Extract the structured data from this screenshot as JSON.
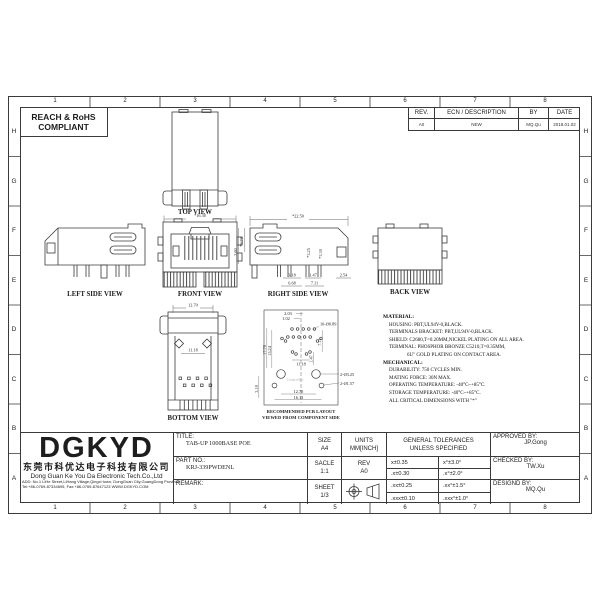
{
  "sheet": {
    "grid_columns": [
      "1",
      "2",
      "3",
      "4",
      "5",
      "6",
      "7",
      "8"
    ],
    "grid_rows": [
      "H",
      "G",
      "F",
      "E",
      "D",
      "C",
      "B",
      "A"
    ],
    "compliance_line1": "REACH & RoHS",
    "compliance_line2": "COMPLIANT",
    "revision": {
      "headers": [
        "REV.",
        "ECN / DESCRIPTION",
        "BY",
        "DATE"
      ],
      "row": {
        "rev": "A0",
        "description": "NEW",
        "by": "MQ.Qu",
        "date": "2018.01.02"
      }
    }
  },
  "views": {
    "top": {
      "label": "TOP VIEW"
    },
    "front": {
      "label": "FRONT VIEW",
      "dim_width": "*16.30"
    },
    "left": {
      "label": "LEFT SIDE VIEW"
    },
    "right": {
      "label": "RIGHT SIDE VIEW",
      "dim_width": "*22.50",
      "dim_h1": "*3.70",
      "dim_h2": "3.60",
      "dim_p1": "*3.25",
      "dim_p2": "*3.30",
      "dim_b1": "3.18",
      "dim_b2": "6.68",
      "dim_b3": "1.47",
      "dim_b4": "7.11",
      "dim_b5": "2.54"
    },
    "back": {
      "label": "BACK VIEW"
    },
    "bottom": {
      "label": "BOTTOM VIEW",
      "dim_width": "12.70",
      "dim_inner": "11.18"
    },
    "pcb": {
      "label_line1": "RECOMMENDED PCB LAYOUT",
      "label_line2": "VIEWED FROM COMPONENT SIDE",
      "dim_pitch": "2.03",
      "dim_offset": "1.02",
      "dim_holes": "10-Ø0.89",
      "dim_v1": "17.78",
      "dim_v2": "15.24",
      "dim_mid": "11.18",
      "dim_r1": "7.11",
      "dim_r2": "1.47",
      "dim_bl": "3.18",
      "dim_bot1": "12.70",
      "dim_bot2": "16.13",
      "dim_mount": "2-Ø3.25",
      "dim_peg": "2-Ø1.57",
      "watermark": "Centerline"
    }
  },
  "notes": {
    "material_title": "MATERIAL:",
    "material": [
      "HOUSING: PBT,UL94V-0,BLACK.",
      "TERMINALS BRACKET: PBT,UL94V-0,BLACK.",
      "SHIELD: C2680,T=0.20MM,NICKEL PLATING ON ALL AREA.",
      "TERMINAL: PHOSPHOR BRONZE C5210,T=0.35MM,",
      "6U\" GOLD PLATING ON CONTACT AREA."
    ],
    "mechanical_title": "MECHANICAL:",
    "mechanical": [
      "DURABILITY: 750 CYCLES MIN.",
      "MATING FORCE: 30N MAX.",
      "OPERATING TEMPERATURE: -40°C~+85°C.",
      "STORAGE TEMPERATURE: -40°C~+85°C.",
      "ALL CRITICAL DIMENSIONS WITH \"*\""
    ]
  },
  "title_block": {
    "logo": "DGKYD",
    "company_cn": "东莞市科优达电子科技有限公司",
    "company_en": "Dong Guan Ke You Da Electronic Tech.Co.,Ltd",
    "address1": "ADD: No.1 LiHe Street,LiHang Village,Qingxi town, DongGuan City,GuangDong Province",
    "address2": "Tel:+86-0769-87334695, Fax:+86-0769-87647123  WWW.DGKYD.COM",
    "title_label": "TITLE:",
    "title_value": "TAB-UP 1000BASE POE",
    "part_label": "PART NO.:",
    "part_value": "KRJ-339PWDENL",
    "remark_label": "REMARK:",
    "size_label": "SIZE",
    "size_value": "A4",
    "units_label": "UNITS",
    "units_value": "MM[INCH]",
    "scale_label": "SACLE",
    "scale_value": "1:1",
    "rev_label": "REV",
    "rev_value": "A0",
    "sheet_label": "SHEET",
    "sheet_value": "1/3",
    "tol_title1": "GENERAL TOLERANCES",
    "tol_title2": "UNLESS SPECIFIED",
    "tol": [
      "x±0.35",
      "x°±3.0°",
      ".x±0.30",
      ".x°±2.0°",
      ".xx±0.25",
      ".xx°±1.5°",
      ".xxx±0.10",
      ".xxx°±1.0°"
    ],
    "approved_label": "APPROVED BY:",
    "approved_value": "JP.Gong",
    "checked_label": "CHECKED BY:",
    "checked_value": "TW.Xu",
    "designed_label": "DESIGND BY:",
    "designed_value": "MQ.Qu"
  }
}
